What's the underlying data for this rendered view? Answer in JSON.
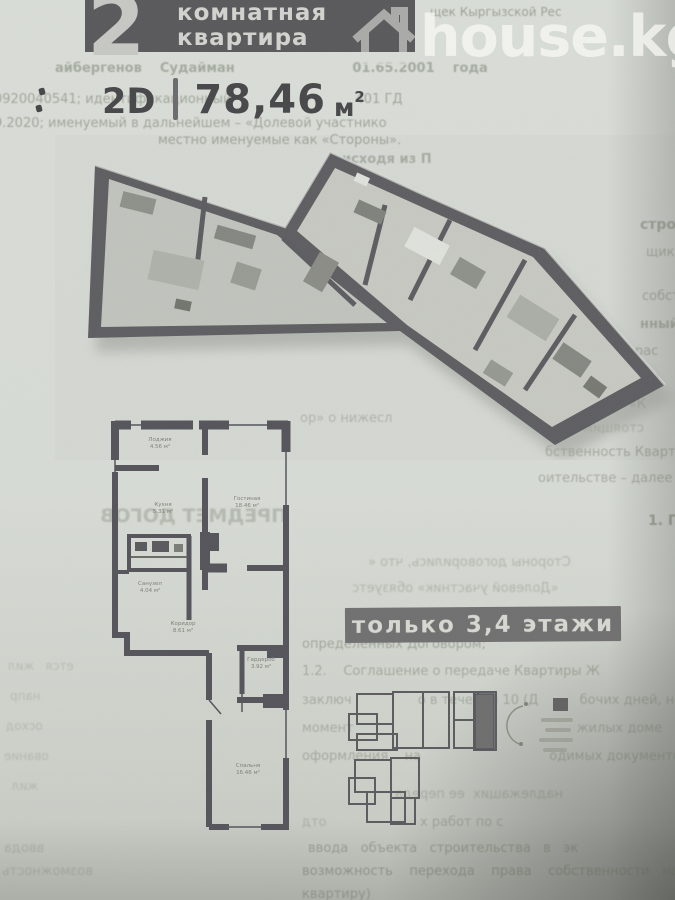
{
  "page": {
    "width": 675,
    "height": 900
  },
  "colors": {
    "paper": "#d7dbd5",
    "banner_bg": "#59595c",
    "banner_text": "#d2d3cf",
    "banner_number": "#c7c8c4",
    "watermark": "rgba(248,249,245,0.78)",
    "title_text": "#47474a",
    "badge_bg": "#707070",
    "badge_text": "#d7d8d2",
    "wall": "#54545a",
    "overview_highlight": "#6e6e6e"
  },
  "banner": {
    "number": "2",
    "line1": "комнатная",
    "line2": "квартира"
  },
  "watermark": {
    "text": "house.kg",
    "icon": "house-icon"
  },
  "title": {
    "view": "2D",
    "separator": "|",
    "area": "78,46",
    "unit": "м",
    "sup": "2"
  },
  "badge": {
    "text": "только 3,4 этажи"
  },
  "floorplan_2d": {
    "room_labels": [
      {
        "name": "Лоджия",
        "area": "4.56 м²",
        "x": 160,
        "y": 437
      },
      {
        "name": "Кухня",
        "area": "5.31 м²",
        "x": 163,
        "y": 502
      },
      {
        "name": "Гостиная",
        "area": "18.46 м²",
        "x": 247,
        "y": 496
      },
      {
        "name": "Санузел",
        "area": "4.04 м²",
        "x": 150,
        "y": 581
      },
      {
        "name": "Коридор",
        "area": "8.61 м²",
        "x": 183,
        "y": 621
      },
      {
        "name": "Гардероб",
        "area": "3.92 м²",
        "x": 261,
        "y": 657
      },
      {
        "name": "Спальня",
        "area": "16.46 м²",
        "x": 248,
        "y": 763
      }
    ]
  },
  "background_text": {
    "lines": [
      {
        "t": "щек Кыргызской Рес",
        "x": 430,
        "y": 6,
        "s": 12,
        "b": 0,
        "m": 0,
        "o": 0.5
      },
      {
        "t": "айбергенов    Судайман                          01.65.2001    года",
        "x": 55,
        "y": 62,
        "s": 13,
        "b": 1,
        "m": 0,
        "o": 0.42
      },
      {
        "t": "0920040541; идентификационный                              401 ГД",
        "x": -6,
        "y": 93,
        "s": 13,
        "b": 0,
        "m": 0,
        "o": 0.45
      },
      {
        "t": "9.2020; именуемый в дальнейшем – «Долевой участнико",
        "x": -6,
        "y": 117,
        "s": 13,
        "b": 0,
        "m": 0,
        "o": 0.45
      },
      {
        "t": "местно именуемые как «Стороны».",
        "x": 158,
        "y": 134,
        "s": 13,
        "b": 0,
        "m": 0,
        "o": 0.48
      },
      {
        "t": "исходя из П",
        "x": 342,
        "y": 153,
        "s": 13,
        "b": 1,
        "m": 0,
        "o": 0.4
      },
      {
        "t": "стро",
        "x": 640,
        "y": 218,
        "s": 14,
        "b": 1,
        "m": 0,
        "o": 0.45
      },
      {
        "t": "щик",
        "x": 646,
        "y": 246,
        "s": 13,
        "b": 0,
        "m": 0,
        "o": 0.4
      },
      {
        "t": "собст",
        "x": 642,
        "y": 290,
        "s": 13,
        "b": 0,
        "m": 0,
        "o": 0.42
      },
      {
        "t": "нный",
        "x": 640,
        "y": 318,
        "s": 13,
        "b": 1,
        "m": 0,
        "o": 0.4
      },
      {
        "t": "і), рас",
        "x": 618,
        "y": 345,
        "s": 13,
        "b": 0,
        "m": 0,
        "o": 0.42
      },
      {
        "t": "Р, г. Ба",
        "x": 612,
        "y": 372,
        "s": 13,
        "b": 0,
        "m": 0,
        "o": 0.45
      },
      {
        "t": "ее – «К",
        "x": 598,
        "y": 398,
        "s": 13,
        "b": 0,
        "m": 0,
        "o": 0.42
      },
      {
        "t": "стоящим",
        "x": 583,
        "y": 422,
        "s": 13,
        "b": 0,
        "m": 1,
        "o": 0.32
      },
      {
        "t": "бственность Квартиры; Сторон",
        "x": 545,
        "y": 446,
        "s": 13,
        "b": 0,
        "m": 0,
        "o": 0.42
      },
      {
        "t": "оительстве – далее по текст: «Догов",
        "x": 538,
        "y": 472,
        "s": 13,
        "b": 0,
        "m": 0,
        "o": 0.4
      },
      {
        "t": "ор» о нижесл",
        "x": 300,
        "y": 412,
        "s": 13,
        "b": 0,
        "m": 0,
        "o": 0.32
      },
      {
        "t": "1. П",
        "x": 648,
        "y": 514,
        "s": 14,
        "b": 1,
        "m": 0,
        "o": 0.5
      },
      {
        "t": "ПРЕДМЕТ ДОГОВ",
        "x": 100,
        "y": 506,
        "s": 19,
        "b": 1,
        "m": 1,
        "o": 0.28
      },
      {
        "t": "Стороны договорились, что «",
        "x": 368,
        "y": 556,
        "s": 13,
        "b": 0,
        "m": 1,
        "o": 0.3
      },
      {
        "t": "«Долевой участник» обязуетс",
        "x": 352,
        "y": 582,
        "s": 13,
        "b": 0,
        "m": 1,
        "o": 0.3
      },
      {
        "t": "определенных Договором;",
        "x": 302,
        "y": 638,
        "s": 13,
        "b": 0,
        "m": 0,
        "o": 0.42
      },
      {
        "t": "1.2.    Соглашение о передаче Квартиры Ж",
        "x": 302,
        "y": 665,
        "s": 13,
        "b": 0,
        "m": 0,
        "o": 0.38
      },
      {
        "t": "заключ                о в течении 10 (Д          бочих дней, но не",
        "x": 302,
        "y": 694,
        "s": 13,
        "b": 0,
        "m": 0,
        "o": 0.36
      },
      {
        "t": "момент                                                      жилых доме",
        "x": 302,
        "y": 722,
        "s": 13,
        "b": 0,
        "m": 0,
        "o": 0.34
      },
      {
        "t": "оформления    на                               одимых документов",
        "x": 302,
        "y": 750,
        "s": 13,
        "b": 0,
        "m": 0,
        "o": 0.36
      },
      {
        "t": "надлежащих  ее переда",
        "x": 395,
        "y": 788,
        "s": 13,
        "b": 0,
        "m": 1,
        "o": 0.3
      },
      {
        "t": "отд",
        "x": 302,
        "y": 816,
        "s": 13,
        "b": 0,
        "m": 1,
        "o": 0.28
      },
      {
        "t": "х работ по с",
        "x": 420,
        "y": 816,
        "s": 13,
        "b": 0,
        "m": 0,
        "o": 0.34
      },
      {
        "t": "ввода   объекта   строительства   в   эк",
        "x": 308,
        "y": 842,
        "s": 13,
        "b": 0,
        "m": 0,
        "o": 0.42
      },
      {
        "t": "возможность    перехода    права    собственности   на   незав",
        "x": 302,
        "y": 865,
        "s": 13,
        "b": 0,
        "m": 0,
        "o": 0.45
      },
      {
        "t": "квартиру)",
        "x": 302,
        "y": 888,
        "s": 13,
        "b": 0,
        "m": 0,
        "o": 0.4
      },
      {
        "t": "ввода",
        "x": 4,
        "y": 842,
        "s": 13,
        "b": 0,
        "m": 1,
        "o": 0.25
      },
      {
        "t": "возможность",
        "x": 2,
        "y": 865,
        "s": 13,
        "b": 0,
        "m": 1,
        "o": 0.25
      },
      {
        "t": "ется   жил",
        "x": 8,
        "y": 660,
        "s": 12,
        "b": 0,
        "m": 1,
        "o": 0.22
      },
      {
        "t": "напр",
        "x": 10,
        "y": 690,
        "s": 12,
        "b": 0,
        "m": 1,
        "o": 0.22
      },
      {
        "t": "осход",
        "x": 6,
        "y": 720,
        "s": 12,
        "b": 0,
        "m": 1,
        "o": 0.22
      },
      {
        "t": "ование",
        "x": 4,
        "y": 750,
        "s": 12,
        "b": 0,
        "m": 1,
        "o": 0.22
      },
      {
        "t": "жил",
        "x": 12,
        "y": 780,
        "s": 12,
        "b": 0,
        "m": 1,
        "o": 0.22
      }
    ]
  }
}
